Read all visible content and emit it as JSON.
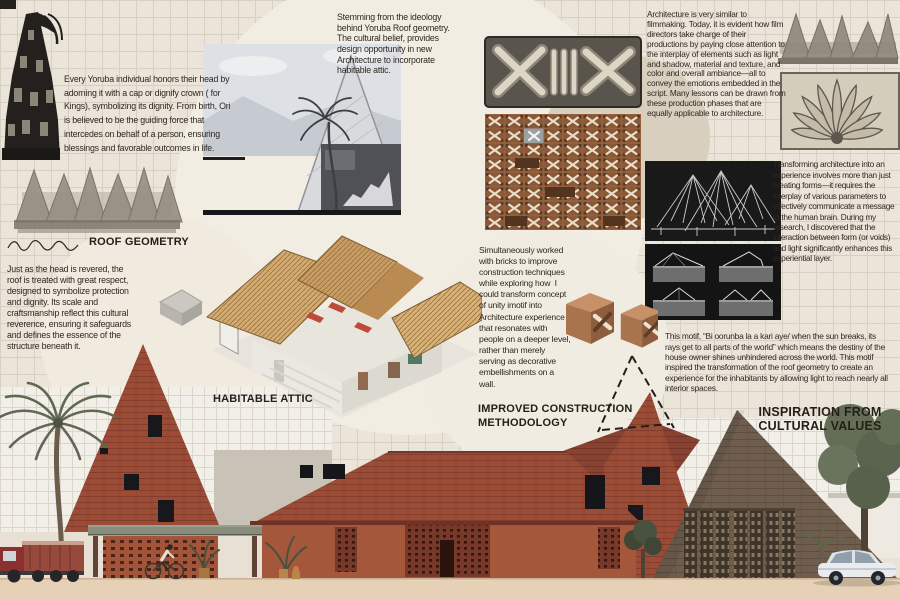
{
  "texts": {
    "ori_belief": "Every Yoruba individual honors their head by adorning it with a cap or dignify crown ( for Kings), symbolizing its dignity. From birth, Ori is believed to be the guiding force that intercedes on behalf of a person, ensuring blessings and favorable outcomes in life.",
    "roof_reverence": "Just as the head is revered, the roof is treated with great respect, designed to symbolize protection and dignity. Its scale and craftsmanship reflect this cultural reverence, ensuring it safeguards and defines the essence of the structure beneath it.",
    "attic_ideology": "Stemming from the ideology behind Yoruba Roof geometry. The cultural belief, provides design opportunity in new Architecture to incorporate  habitable attic.",
    "filmmaking": "Architecture is very similar to filmmaking. Today, it is evident how film directors take charge of their productions by paying close attention to the interplay of elements such as light and shadow, material and texture, and color and overall ambiance—all to convey the emotions embedded in the script. Many lessons can be drawn from these production phases that are equally applicable to architecture.",
    "experience": "Transforming architecture into an experience involves more than just creating forms—it requires the interplay of various parameters to effectively communicate a message to the human brain. During my research, I discovered that the interaction between form (or voids) and light significantly enhances this experiential layer.",
    "bricks": "Simultaneously worked with bricks to improve construction techniques while exploring how  I could transform concept of unity imotif into Architecture experience  that resonates with people on a deeper level, rather than merely serving as decorative embellishments on a wall.",
    "motif": "This motif, “Bi oorunba la a kari aye/ when the sun breaks, its rays get to all parts of the world” which means the destiny of the house owner shines unhindered across the world. This motif inspired the transformation of the roof geometry to create an experience for the inhabitants by allowing light to reach nearly all interior spaces."
  },
  "labels": {
    "roof_geometry": "ROOF GEOMETRY",
    "habitable_attic": "HABITABLE ATTIC",
    "improved_construction": "IMPROVED CONSTRUCTION METHODOLOGY",
    "inspiration": "INSPIRATION FROM CULTURAL VALUES"
  },
  "palette": {
    "paper": "#eae4d9",
    "grid_line": "#d7d0c2",
    "ink": "#2f2822",
    "brick_roof": "#9c4b34",
    "brick_wall": "#a5573c",
    "pyramid_brown": "#6f5e4e",
    "photo_black": "#181818",
    "ground_tan": "#e6d0b6"
  }
}
